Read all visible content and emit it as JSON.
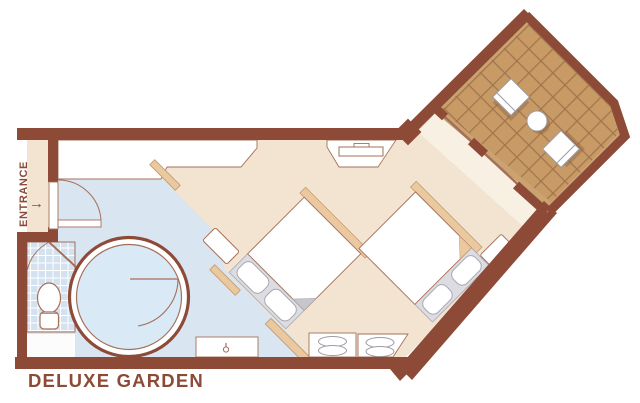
{
  "title": "DELUXE GARDEN",
  "entrance": {
    "label": "ENTRANCE",
    "arrow": "→"
  },
  "theme": {
    "wall": "#8C4A37",
    "outline": "#A5705A",
    "floor": "#F2E4D0",
    "floor-light": "#F8F0E3",
    "hall": "#D9E5F1",
    "tile": "#D4E2F0",
    "shower": "#D9E9F5",
    "tan": "#EBC9A0",
    "tan-border": "#C69C70",
    "deck": "#C79A66",
    "deck-line": "#8F5F3D",
    "deck-margin": "#CBA271",
    "mattress": "#DCDCE2",
    "gray-line": "#A9A9B2",
    "fold": "#C6C6CD",
    "furniture-line": "#9B9BA3"
  }
}
